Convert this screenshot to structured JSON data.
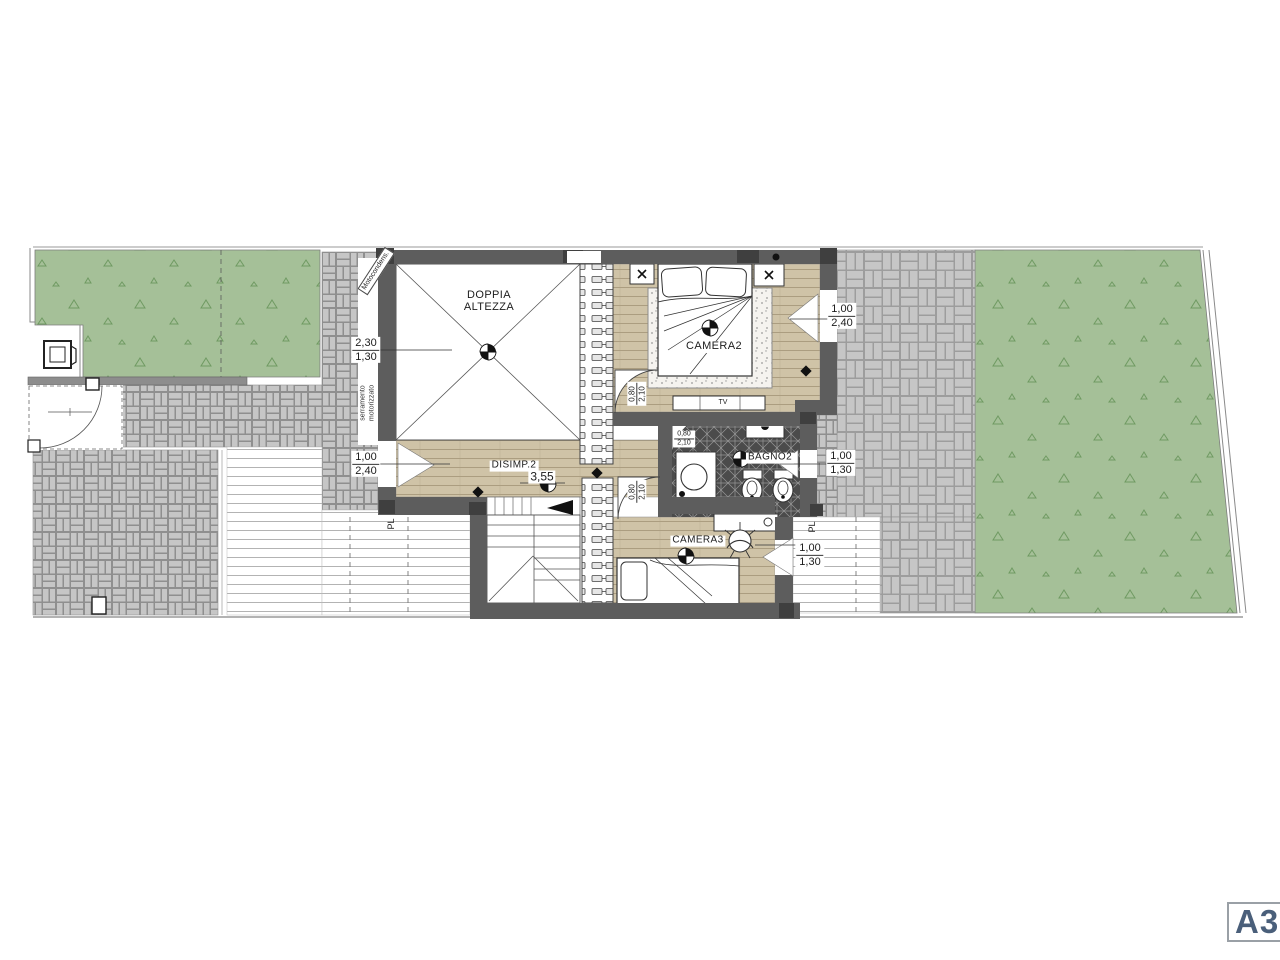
{
  "sheet": {
    "label": "A3"
  },
  "plan": {
    "rooms": {
      "doppia_altezza": {
        "line1": "DOPPIA",
        "line2": "ALTEZZA"
      },
      "camera2": {
        "label": "CAMERA2"
      },
      "bagno2": {
        "label": "BAGNO2"
      },
      "camera3": {
        "label": "CAMERA3"
      },
      "disimp2": {
        "label": "DISIMP.2",
        "width": "3,55"
      },
      "tv": {
        "label": "TV"
      }
    },
    "windows": {
      "w230_130": {
        "w": "2,30",
        "h": "1,30"
      },
      "w100_240_left": {
        "w": "1,00",
        "h": "2,40"
      },
      "w100_240_right": {
        "w": "1,00",
        "h": "2,40"
      },
      "w100_130_bagno": {
        "w": "1,00",
        "h": "1,30"
      },
      "w100_130_camera3": {
        "w": "1,00",
        "h": "1,30"
      }
    },
    "doors": {
      "camera2": {
        "w": "0,80",
        "h": "2,10"
      },
      "bagno2": {
        "w": "0,80",
        "h": "2,10"
      },
      "camera3": {
        "w": "0,80",
        "h": "2,10"
      }
    },
    "annotations": {
      "serramento_line1": "serramento",
      "serramento_line2": "motorizzato",
      "motocondens": "Motocondens.",
      "pl_left": "PL",
      "pl_right": "PL"
    },
    "colors": {
      "grass": "#a5c098",
      "grass_mark": "#6f9a62",
      "paver": "#c6c6c6",
      "paver_line": "#8f8f8f",
      "wall": "#5d5d5d",
      "wood": "#cfc3a7",
      "wood_line": "#ab9d80",
      "tile_dark": "#4b4b4b",
      "tile_line": "#969696",
      "sheet_label": "#4a5f7a"
    }
  }
}
